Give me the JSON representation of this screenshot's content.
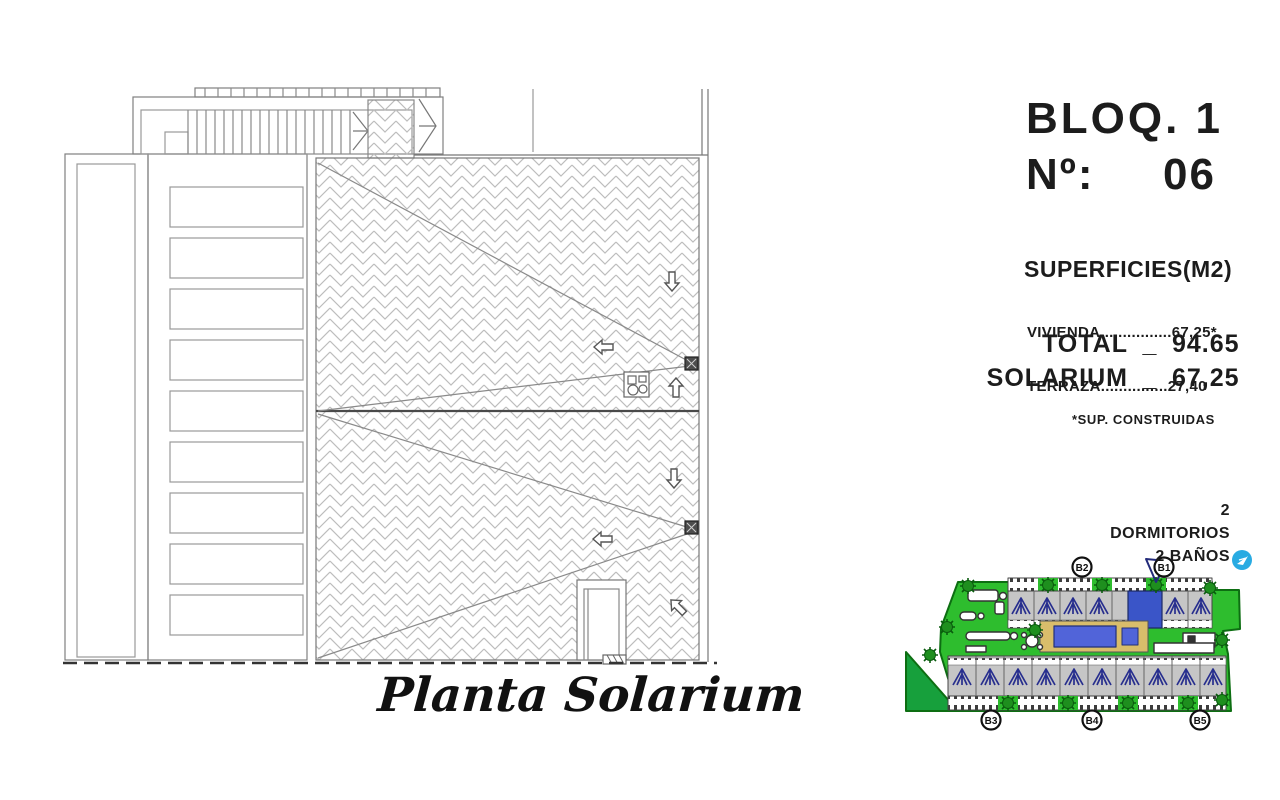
{
  "title_block": {
    "block": "BLOQ. 1",
    "number_label": "Nº:",
    "number": "06",
    "surfaces_title": "SUPERFICIES(M2)",
    "surface_lines": [
      "VIVIENDA................67,25*",
      "TERRAZA...............27,40"
    ],
    "total_label": "TOTAL",
    "total_separator": "_",
    "total_value": "94.65",
    "solarium_label": "SOLARIUM",
    "solarium_separator": "_",
    "solarium_value": "67,25",
    "footnote": "*SUP. CONSTRUIDAS",
    "features": [
      "2 DORMITORIOS",
      "2 BAÑOS"
    ]
  },
  "plan": {
    "caption": "Planta Solarium"
  },
  "siteplan": {
    "block_labels": [
      "B2",
      "B1",
      "B3",
      "B4",
      "B5"
    ],
    "colors": {
      "grass": "#2ebd2e",
      "grass_dark": "#17a03c",
      "tree": "#1e8f1e",
      "building_gray": "#c6c6c6",
      "unit_highlight": "#3a55c8",
      "pool": "#5164d9",
      "deck": "#d9bd6b",
      "pergola": "#272e8e",
      "logo_blue": "#29abe2"
    }
  }
}
